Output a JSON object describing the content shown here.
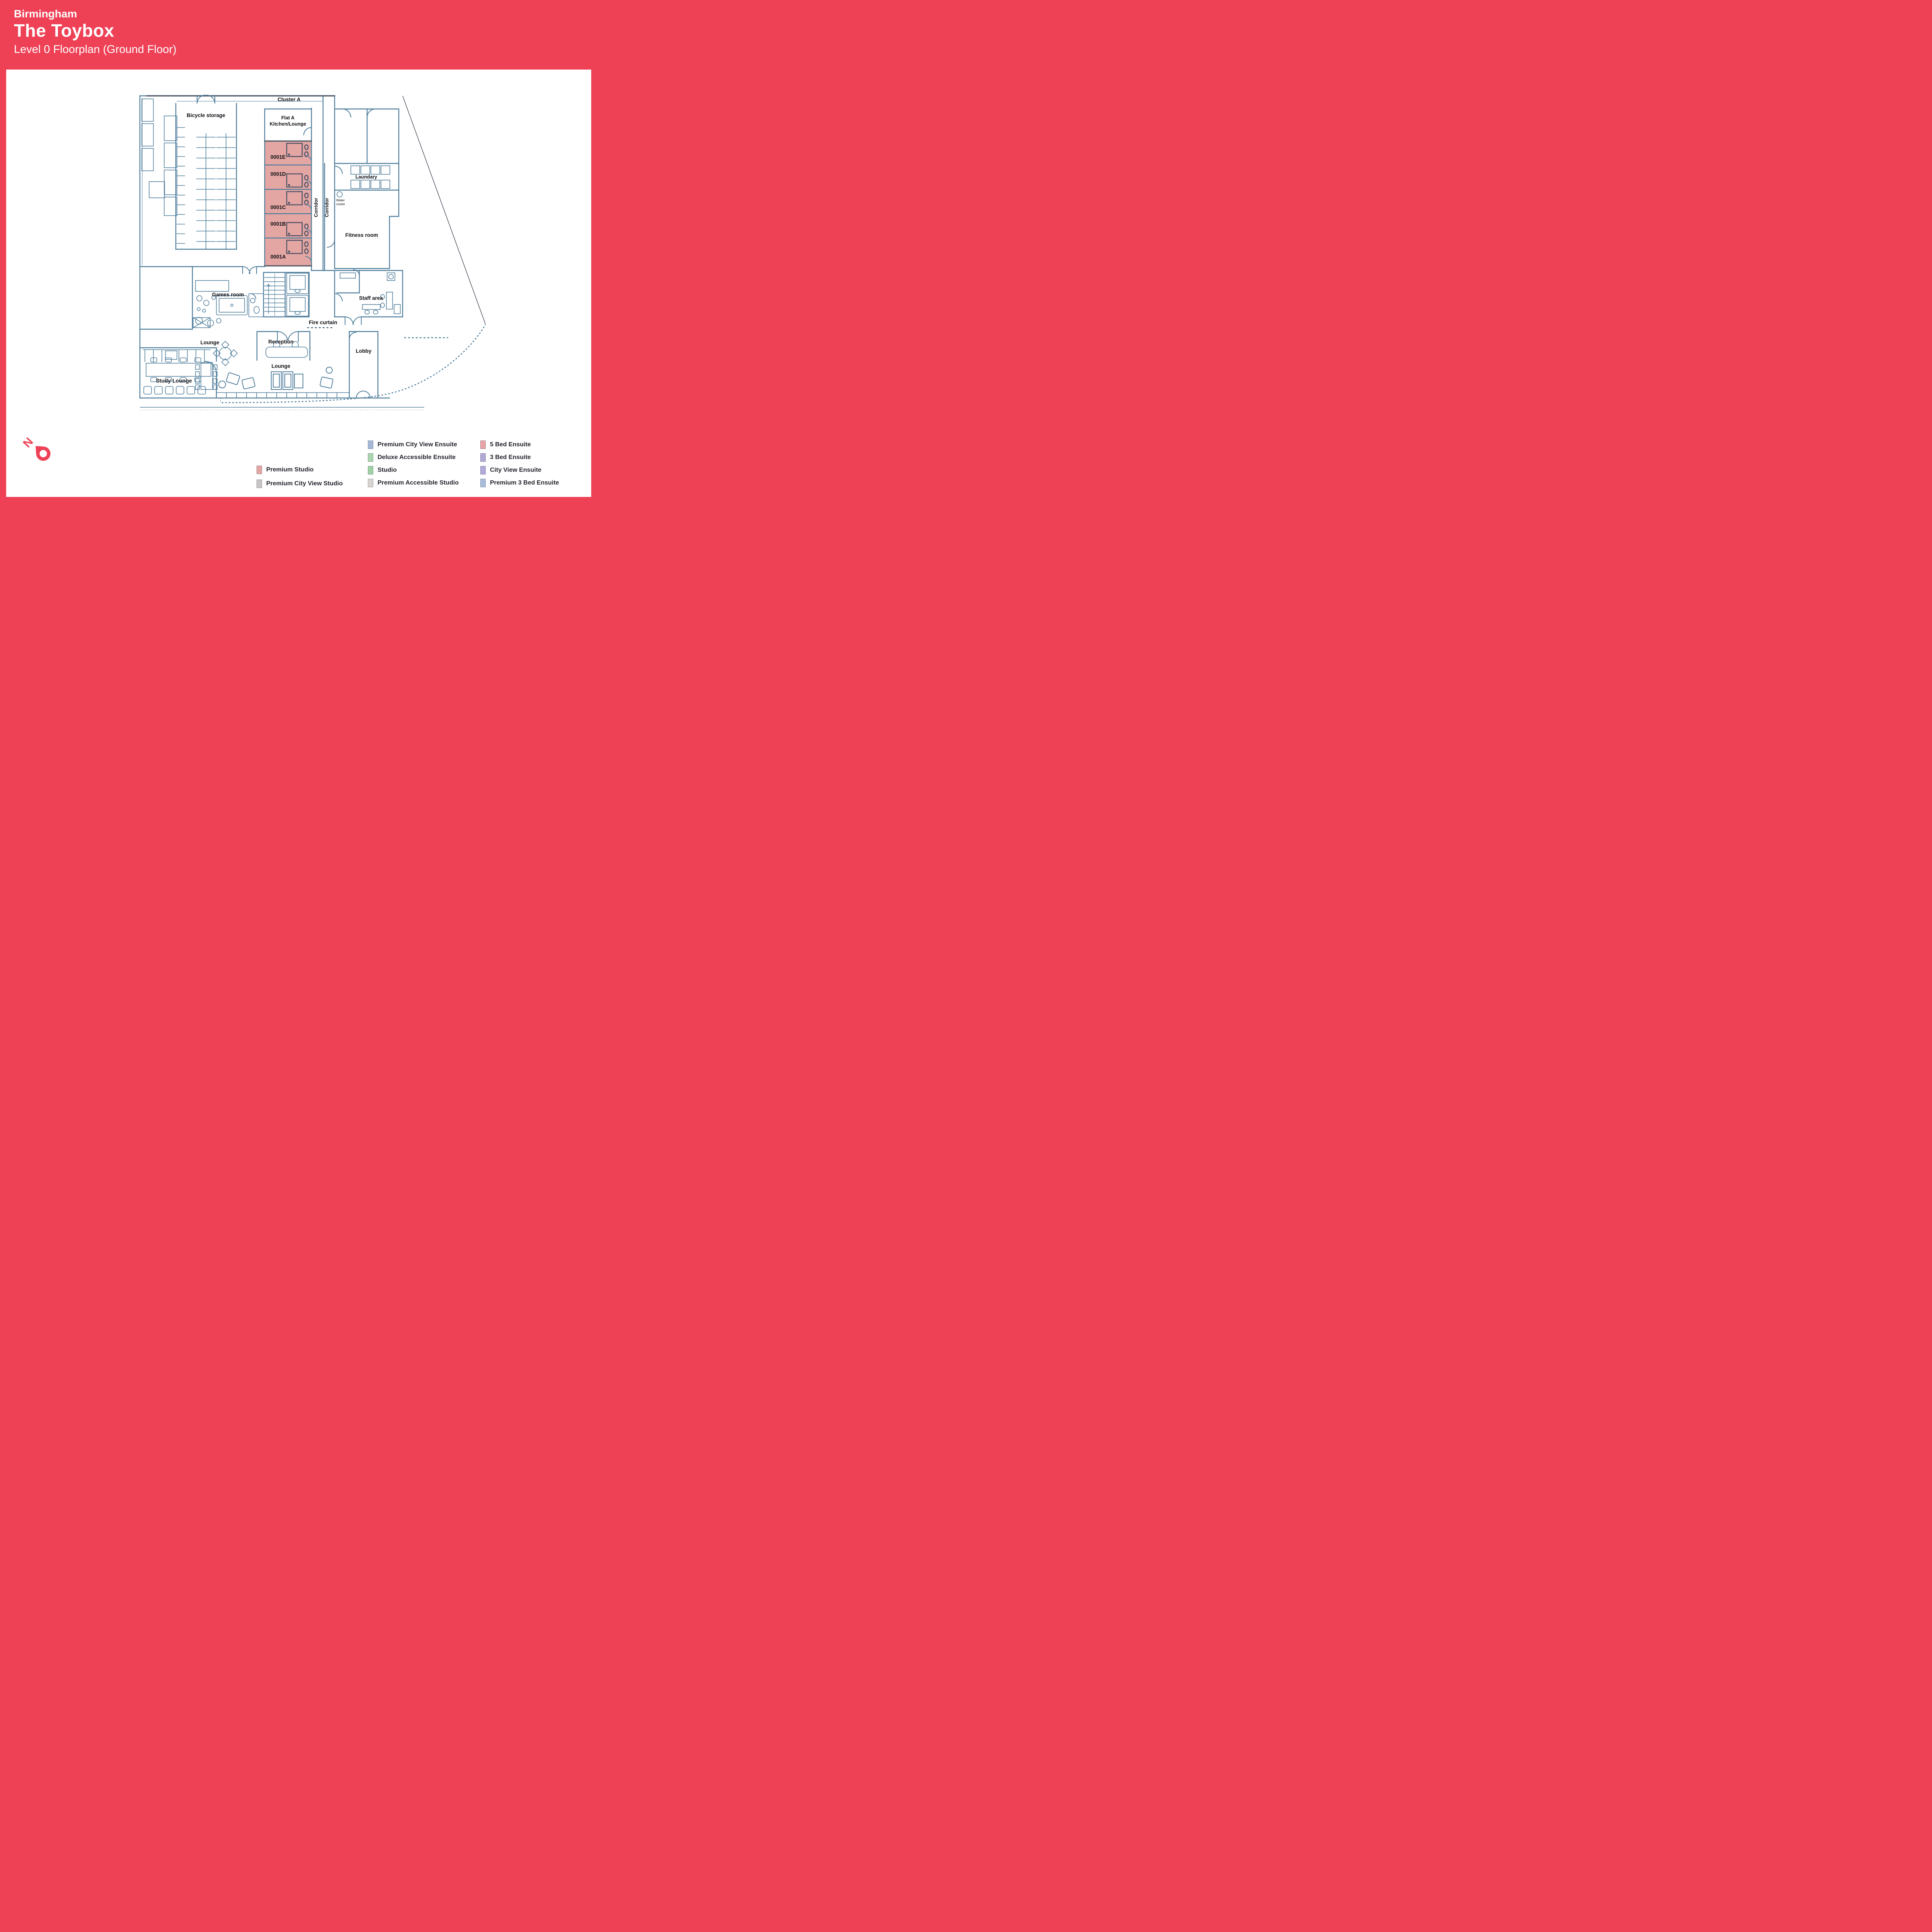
{
  "header": {
    "city": "Birmingham",
    "name": "The Toybox",
    "subtitle": "Level 0 Floorplan (Ground Floor)"
  },
  "plan": {
    "cluster": "Cluster A",
    "bicycle_storage": "Bicycle storage",
    "flat_a_line1": "Flat A",
    "flat_a_line2": "Kitchen/Lounge",
    "rooms": {
      "e": "0001E",
      "d": "0001D",
      "c": "0001C",
      "b": "0001B",
      "a": "0001A"
    },
    "corridor": "Corridor",
    "laundry": "Laundary",
    "water_line1": "Water",
    "water_line2": "cooler",
    "fitness": "Fitness room",
    "games": "Games room",
    "staff": "Staff area",
    "fire_curtain": "Fire curtain",
    "lounge_west": "Lounge",
    "reception": "Reception",
    "lobby": "Lobby",
    "lounge_south": "Lounge",
    "study": "Study Lounge"
  },
  "compass": {
    "letter": "N"
  },
  "colors": {
    "brand": "#ef4156",
    "wall": "#4e7d9b",
    "wall_dark": "#4b5563",
    "unit_fill": "#e3a6a3",
    "pod": "#474f63"
  },
  "legend": {
    "col1": [
      {
        "label": "Premium Studio",
        "color": "#e3a6a3"
      },
      {
        "label": "Premium City View Studio",
        "color": "#c9c5c5"
      }
    ],
    "col2": [
      {
        "label": "Premium City View Ensuite",
        "color": "#a6b8d6"
      },
      {
        "label": "Deluxe Accessible Ensuite",
        "color": "#abd5af"
      },
      {
        "label": "Studio",
        "color": "#9fd2a5"
      },
      {
        "label": "Premium Accessible Studio",
        "color": "#d9d4d0"
      }
    ],
    "col3": [
      {
        "label": "5 Bed Ensuite",
        "color": "#e7a3a6"
      },
      {
        "label": "3 Bed Ensuite",
        "color": "#b2a9d4"
      },
      {
        "label": "City View Ensuite",
        "color": "#b2a9da"
      },
      {
        "label": "Premium 3 Bed Ensuite",
        "color": "#a9bddb"
      }
    ]
  }
}
